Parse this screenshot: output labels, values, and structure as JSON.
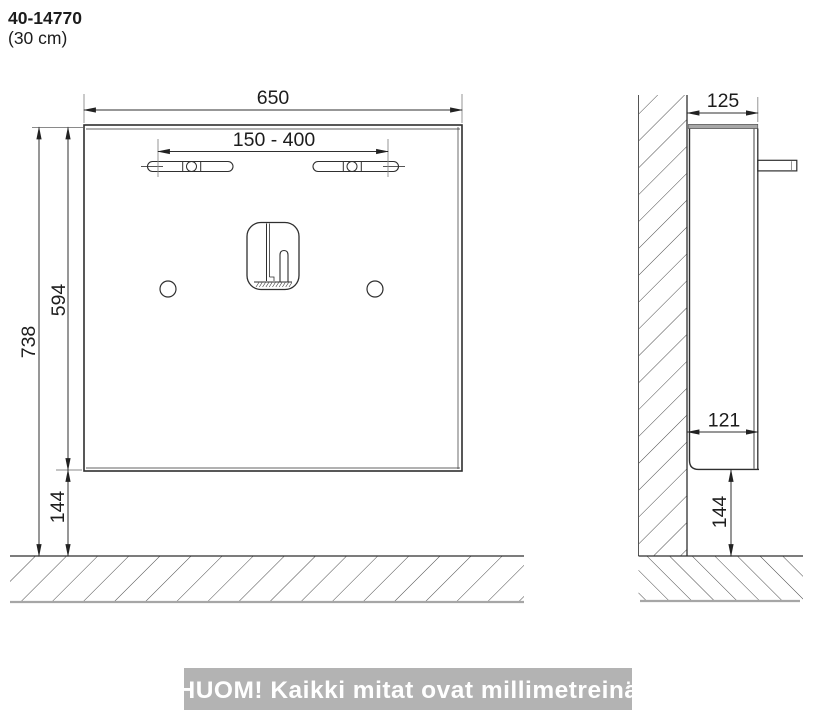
{
  "title_block": {
    "product_code": "40-14770",
    "variant": "(30 cm)"
  },
  "front_view": {
    "dimensions": {
      "overall_width": "650",
      "mount_slot_range": "150 - 400",
      "overall_height_from_floor": "738",
      "panel_height": "594",
      "bottom_clearance": "144"
    }
  },
  "side_view": {
    "dimensions": {
      "overall_depth": "125",
      "body_depth": "121",
      "bottom_clearance": "144"
    }
  },
  "footer_note": {
    "text": "HUOM! Kaikki mitat ovat millimetreinä"
  },
  "colors": {
    "line": "#2f2f2f",
    "hatch": "#4a4a4a",
    "note_bar_bg": "#b3b3b3",
    "note_bar_text": "#ffffff"
  },
  "units": "mm"
}
